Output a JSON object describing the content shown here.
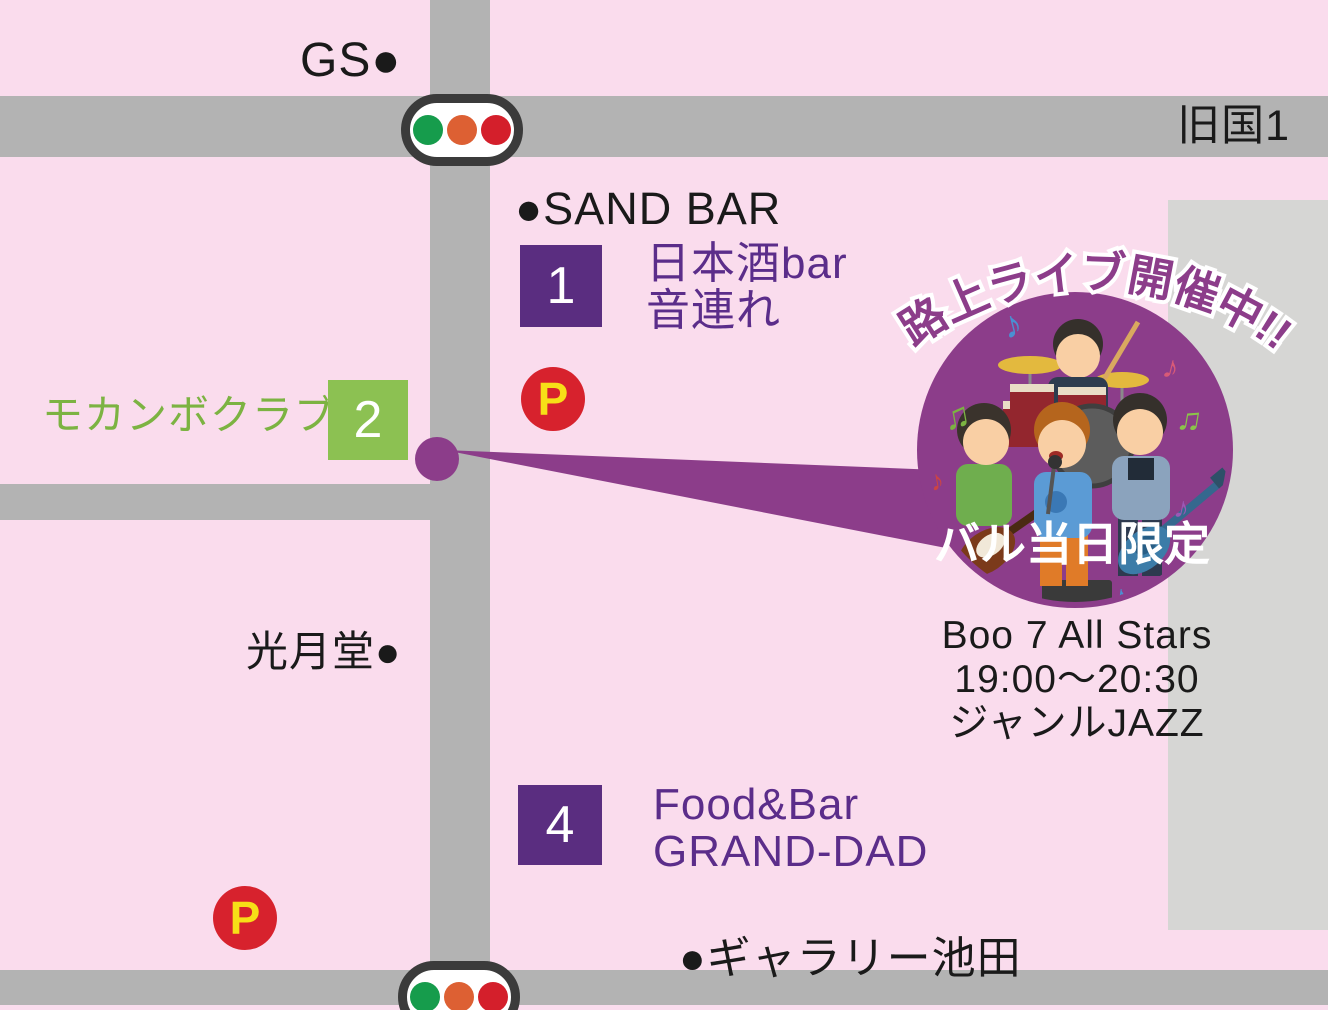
{
  "map_title": "bar-crawl street-live event map",
  "colors": {
    "background": "#fadced",
    "road": "#b3b3b3",
    "building": "#d6d6d4",
    "venue_purple": "#5a2d80",
    "venue_text_purple": "#5b2d8a",
    "venue_green": "#8cc152",
    "event_purple": "#8c3d8a",
    "parking_red": "#d7222d",
    "parking_letter_yellow": "#f7df17",
    "signal_green": "#169c4c",
    "signal_orange": "#dd6033",
    "signal_red": "#d41f2b"
  },
  "roads": {
    "route_label": "旧国1"
  },
  "landmarks": {
    "gas_station": "GS●",
    "sand_bar": "●SAND BAR",
    "kogetsudo": "光月堂●",
    "gallery_ikeda": "●ギャラリー池田"
  },
  "venues": {
    "v1": {
      "number": "1",
      "line1": "日本酒bar",
      "line2": "音連れ"
    },
    "v2": {
      "number": "2",
      "name": "モカンボクラブ"
    },
    "v4": {
      "number": "4",
      "line1": "Food&Bar",
      "line2": "GRAND-DAD"
    }
  },
  "parking": {
    "label": "P"
  },
  "event": {
    "headline": "路上ライブ開催中!!",
    "badge": "バル当日限定",
    "band": "Boo 7 All Stars",
    "time": "19:00〜20:30",
    "genre": "ジャンルJAZZ",
    "notes": [
      "♪",
      "♫",
      "♪",
      "♫",
      "♪",
      "♪",
      "♪"
    ]
  }
}
